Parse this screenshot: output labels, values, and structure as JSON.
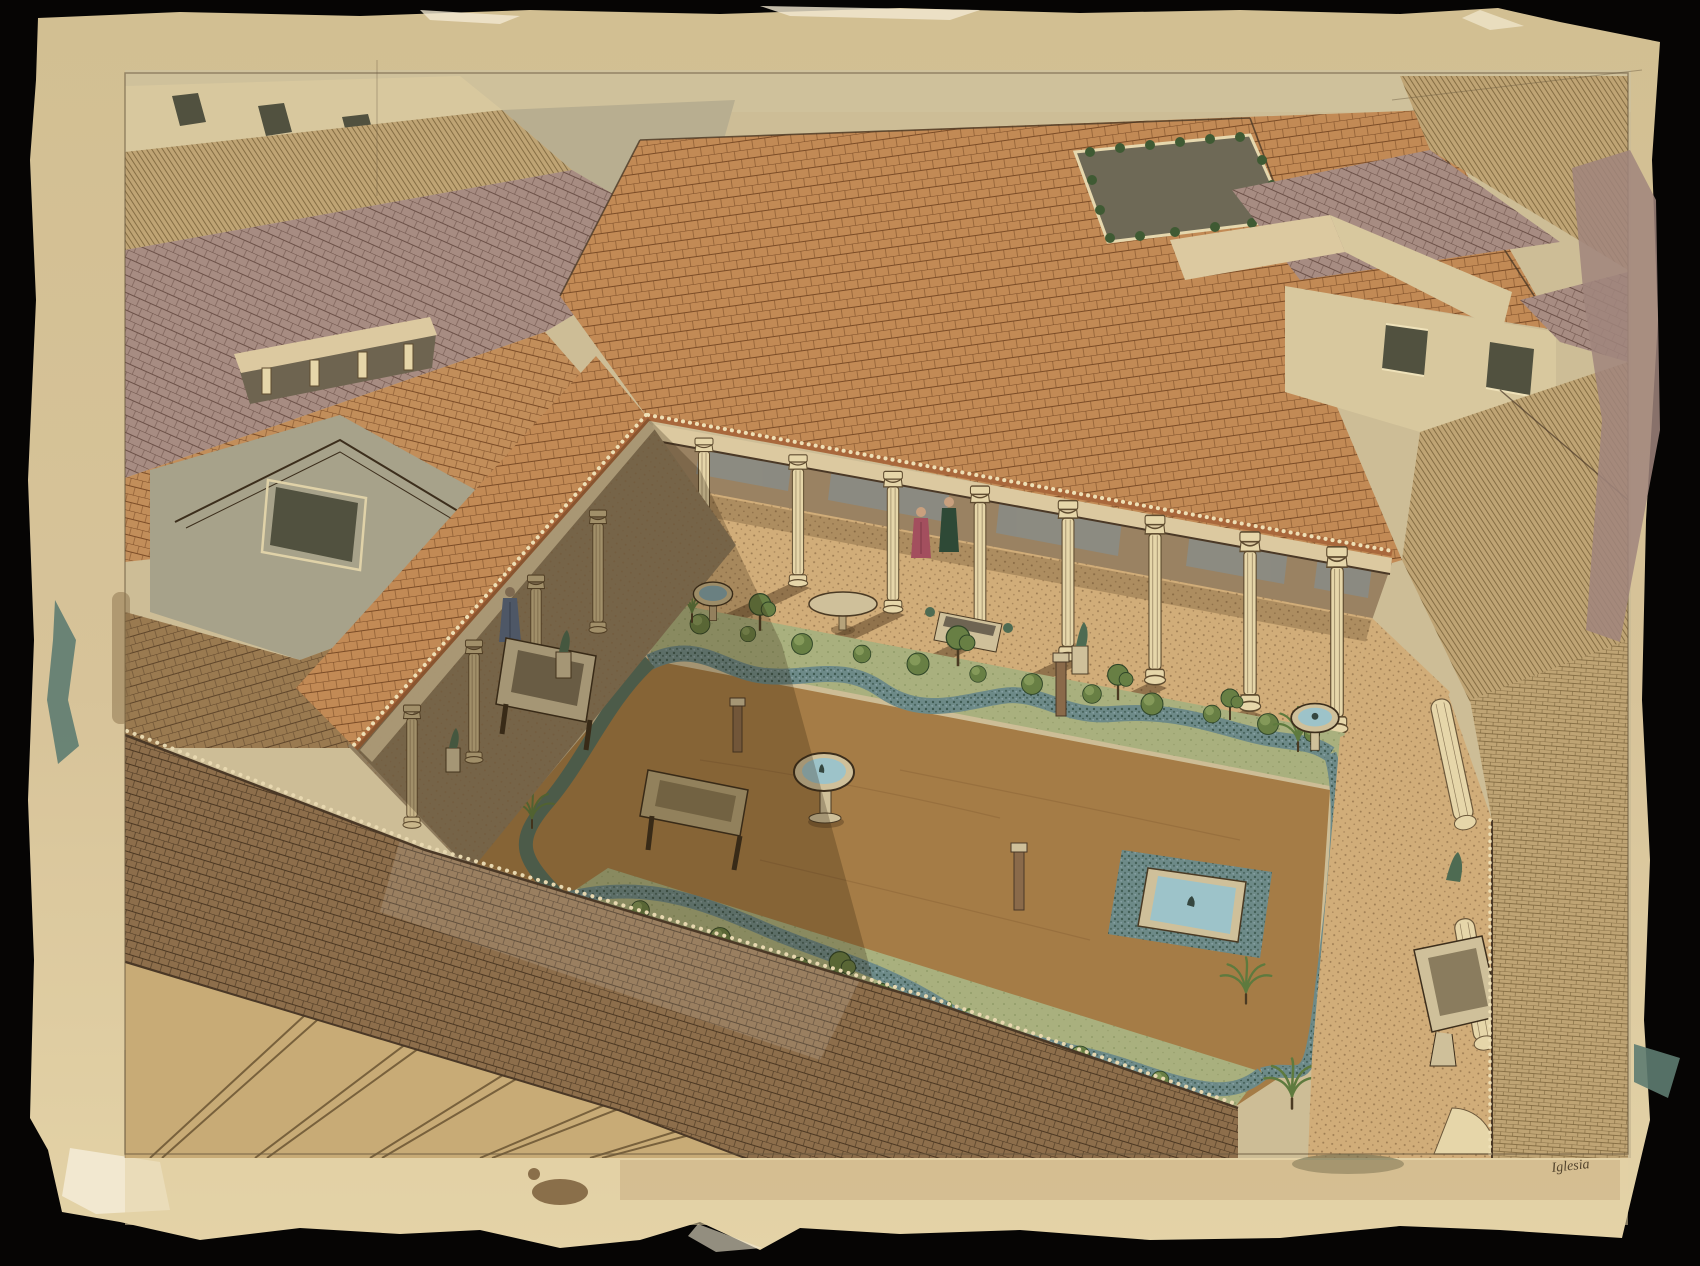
{
  "artwork": {
    "signature": "Iglesia",
    "description": "Aerial watercolor-and-ink reconstruction of a Roman peristyle house: a colonnaded garden courtyard with fountains, pools, statues and two robed figures, surrounded by a dense terracotta-tiled roofscape, painted on a torn-edged sheet over a black background",
    "scene_elements": [
      "torn-edge watercolor paper",
      "pencil border frame",
      "street band",
      "tiled roofscape",
      "slit windows",
      "pediment with window",
      "rooftop loggia",
      "light-well courtyard with shrubs",
      "wall with square windows",
      "peristyle colonnade",
      "corinthian columns",
      "column shadows",
      "mosaic portico floor",
      "gray wall panels",
      "garden with earthen court",
      "clipped hedges",
      "garden beds with shrubs",
      "palms",
      "square pool with fountain jet",
      "round fountain basin",
      "marble trough",
      "stone table",
      "round table",
      "bronze statues",
      "figure in red robe",
      "figure in dark green robe",
      "figure in blue robe",
      "cut-away columns",
      "paint test smudges",
      "artist signature"
    ]
  },
  "palette": {
    "black_bg": "#060504",
    "paper": "#d6c298",
    "paper_edge": "#f2e9d2",
    "paper_margin": "#e3d2a6",
    "pencil": "#6b5a40",
    "ink": "#3c2e1c",
    "line_dark": "#4a3826",
    "tile_orange": "#c28a55",
    "tile_orange_line": "#7b4c27",
    "tile_brown": "#9a7a50",
    "tile_brown_line": "#5e452a",
    "tile_mauve": "#a78c82",
    "tile_mauve_line": "#6b5047",
    "tile_tan": "#bfa474",
    "tile_tan_line": "#776038",
    "roof_fore": "#8d6e4b",
    "roof_fore_line": "#4b3722",
    "street": "#cfc19b",
    "wall_cream": "#d8c89e",
    "wall_gray": "#a7a28a",
    "wall_tan": "#c8ab76",
    "flat_plane": "#b8ae90",
    "window_dark": "#51513f",
    "loggia_dark": "#6e6450",
    "lightwell": "#6e6956",
    "col_cream": "#e6d6a9",
    "col_shade": "#c9b68a",
    "entab": "#dcc9a0",
    "floor_tan": "#d1ad79",
    "floor_dot": "#8a6a44",
    "wall_band": "#9a8262",
    "panel_gray": "#8b8b83",
    "garden_brown": "#a57c46",
    "garden_brown_shade": "#7f6a3f",
    "bed_green": "#a9b07e",
    "bed_green_shade": "#7e8a5c",
    "hedge_teal": "#6d8a88",
    "hedge_dark": "#3e5a52",
    "water_blue": "#9dc3c9",
    "foliage": "#687f44",
    "foliage_dark": "#3f5a33",
    "bronze": "#4e6b52",
    "stone": "#cfc09a",
    "robe_red": "#a34f5e",
    "robe_green": "#2e4936",
    "robe_blue": "#5a6b86",
    "skin": "#c9a07e",
    "stain_teal": "#5e7c71",
    "wash_mauve": "#a0857c",
    "stain_brown": "#8a6f4a",
    "stain_olive": "#6b6b4f"
  }
}
